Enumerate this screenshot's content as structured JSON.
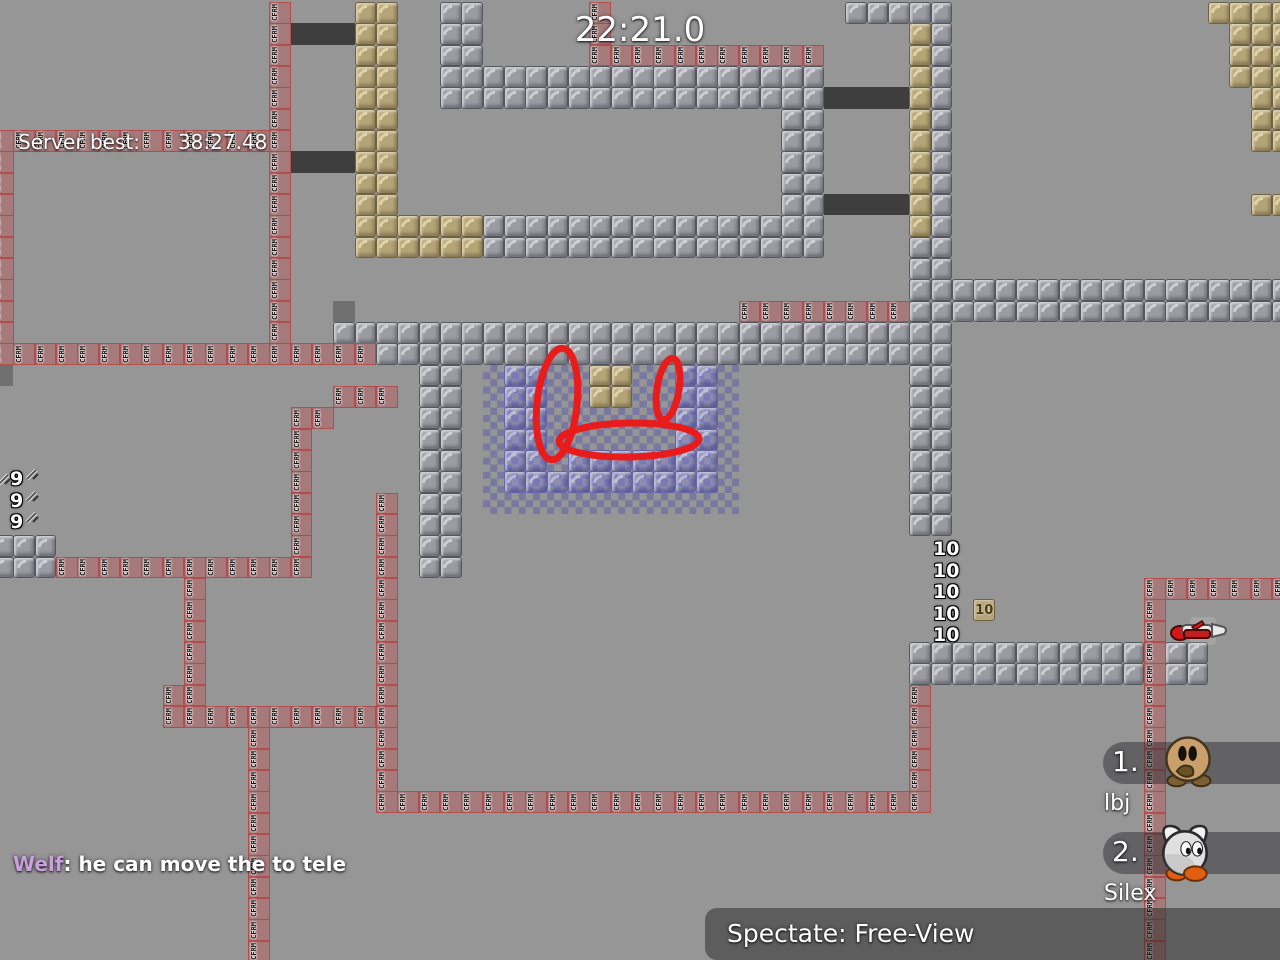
{
  "hud": {
    "timer": "22:21.0",
    "server_best_label": "Server best:",
    "server_best_value": "38:27.48",
    "chat": {
      "name": "Welf",
      "separator": ": ",
      "message": "he can move the to tele",
      "name_color": "#c9a0dc"
    },
    "spectate_label": "Spectate: Free-View",
    "scoreboard": [
      {
        "rank": "1.",
        "name": "lbj"
      },
      {
        "rank": "2.",
        "name": "Silex"
      }
    ]
  },
  "map": {
    "tile_size": 21.3333,
    "origin_x": -8,
    "origin_y": 2,
    "freeze_label": "CFRM",
    "colors": {
      "background": "#969696",
      "unhookable": "#9b9ca3",
      "hookable": "#b5a478",
      "freeze": "#a67a7a",
      "dark_door": "#3e3e3e",
      "glass": "#7e84d4",
      "checker_blue": "rgba(70,70,176,0.38)",
      "annotation_red": "#e91c1c"
    },
    "structures": [
      [
        "M",
        21,
        0,
        2,
        3
      ],
      [
        "M",
        21,
        3,
        18,
        2
      ],
      [
        "M",
        37,
        5,
        2,
        5
      ],
      [
        "M",
        23,
        10,
        16,
        2
      ],
      [
        "M",
        40,
        0,
        5,
        1
      ],
      [
        "M",
        44,
        1,
        1,
        10
      ],
      [
        "M",
        43,
        11,
        2,
        14
      ],
      [
        "M",
        45,
        13,
        16,
        2
      ],
      [
        "M",
        16,
        15,
        27,
        1
      ],
      [
        "M",
        18,
        16,
        25,
        1
      ],
      [
        "M",
        20,
        17,
        2,
        10
      ],
      [
        "M",
        0,
        25,
        3,
        2
      ],
      [
        "M",
        43,
        30,
        14,
        2
      ],
      [
        "K",
        17,
        0,
        2,
        10
      ],
      [
        "K",
        17,
        10,
        6,
        2
      ],
      [
        "K",
        43,
        1,
        1,
        10
      ],
      [
        "K",
        57,
        0,
        4,
        1
      ],
      [
        "K",
        58,
        1,
        1,
        3
      ],
      [
        "K",
        59,
        1,
        2,
        6
      ],
      [
        "K",
        59,
        9,
        2,
        1
      ],
      [
        "K",
        28,
        17,
        2,
        2
      ],
      [
        "F",
        13,
        0,
        1,
        16
      ],
      [
        "F",
        28,
        0,
        1,
        2
      ],
      [
        "F",
        28,
        2,
        11,
        1
      ],
      [
        "F",
        0,
        6,
        13,
        1
      ],
      [
        "F",
        0,
        7,
        1,
        9
      ],
      [
        "F",
        0,
        16,
        18,
        1
      ],
      [
        "F",
        35,
        14,
        8,
        1
      ],
      [
        "F",
        16,
        18,
        3,
        1
      ],
      [
        "F",
        14,
        19,
        2,
        1
      ],
      [
        "F",
        14,
        20,
        1,
        7
      ],
      [
        "F",
        3,
        26,
        11,
        1
      ],
      [
        "F",
        18,
        23,
        1,
        15
      ],
      [
        "F",
        9,
        27,
        1,
        6
      ],
      [
        "F",
        8,
        32,
        1,
        2
      ],
      [
        "F",
        9,
        33,
        9,
        1
      ],
      [
        "F",
        12,
        34,
        1,
        11
      ],
      [
        "F",
        19,
        37,
        25,
        1
      ],
      [
        "F",
        43,
        32,
        1,
        5
      ],
      [
        "F",
        54,
        27,
        7,
        1
      ],
      [
        "F",
        54,
        28,
        1,
        17
      ],
      [
        "D",
        14,
        1,
        3,
        1
      ],
      [
        "D",
        14,
        7,
        3,
        1
      ],
      [
        "D",
        39,
        4,
        4,
        1
      ],
      [
        "D",
        39,
        9,
        4,
        1
      ],
      [
        "H",
        16,
        14,
        1,
        1
      ],
      [
        "H",
        0,
        17,
        1,
        1
      ],
      [
        "G",
        24,
        17,
        2,
        6
      ],
      [
        "G",
        32,
        17,
        2,
        6
      ],
      [
        "G",
        27,
        21,
        5,
        1
      ],
      [
        "G",
        26,
        22,
        6,
        1
      ],
      [
        "T",
        46,
        28,
        1,
        1
      ]
    ],
    "checker": {
      "col": 23,
      "row": 17,
      "cols": 12,
      "rows": 7
    },
    "switch_numbers": {
      "nine_value": "9",
      "nines": [
        {
          "x": 10,
          "y": 468
        },
        {
          "x": 10,
          "y": 490
        },
        {
          "x": 10,
          "y": 511
        }
      ],
      "laser_icons": [
        {
          "x": 25,
          "y": 466
        },
        {
          "x": 25,
          "y": 488
        },
        {
          "x": 25,
          "y": 509
        },
        {
          "x": -3,
          "y": 471
        }
      ],
      "ten_value": "10",
      "tens": [
        {
          "x": 933,
          "y": 538
        },
        {
          "x": 933,
          "y": 560
        },
        {
          "x": 933,
          "y": 581
        },
        {
          "x": 933,
          "y": 603
        },
        {
          "x": 933,
          "y": 624
        }
      ],
      "ten_tile_value": "10"
    },
    "drawing": {
      "stroke_width": 7,
      "ellipses": [
        {
          "cx": 557,
          "cy": 404,
          "rx": 20,
          "ry": 56,
          "rot": 6
        },
        {
          "cx": 668,
          "cy": 389,
          "rx": 11,
          "ry": 31,
          "rot": 9
        },
        {
          "cx": 629,
          "cy": 440,
          "rx": 70,
          "ry": 17,
          "rot": -1
        }
      ]
    }
  }
}
